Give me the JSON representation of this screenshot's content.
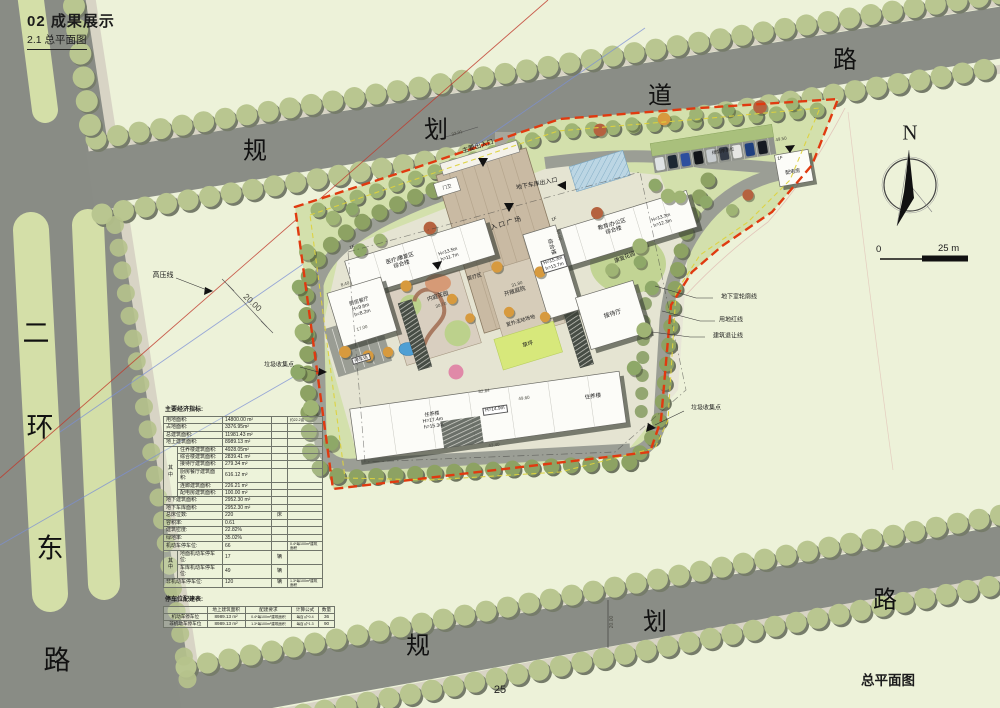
{
  "header": {
    "title": "02  成果展示",
    "subtitle": "2.1 总平面图"
  },
  "roads": {
    "top": [
      "规",
      "划",
      "道",
      "路"
    ],
    "left": [
      "二",
      "环",
      "东",
      "路"
    ],
    "bottom": [
      "规",
      "划",
      "路"
    ]
  },
  "compass": {
    "north": "N"
  },
  "scale": {
    "zero": "0",
    "max": "25 m"
  },
  "plan": {
    "labels": {
      "main_entrance": "主要出入口",
      "garage_entrance": "地下车库出入口",
      "entrance_plaza": "入 口 广 场",
      "bldg_medical": "医疗/康复区\n综合楼",
      "bldg_medical_h": "H=13.5m\nh=11.7m",
      "bldg_edu": "教育/办公区\n综合楼",
      "bldg_edu_h": "H=13.3m\nh=12.3m",
      "bldg_complex": "综合楼",
      "bldg_complex_h": "H=15.3m\nh=13.7m",
      "medical_zone": "医疗区",
      "kitchen": "厨房餐厅\nH=9.6m\nh=8.2m",
      "reception": "接待厅",
      "resident_main": "住养楼\nH=17.4m\nh=15.3m",
      "resident_h2": "H=14.9m",
      "resident_east": "住养楼",
      "power_room": "配电房",
      "floor_1f": "1F",
      "guard": "门卫",
      "shaded_parking": "绿荫停车位",
      "inner_garden": "内庭花园",
      "open_court": "开敞庭院",
      "outdoor_field": "室外活动场地",
      "lawn": "草坪",
      "rehab_garden": "康复花园",
      "parking_lot": "停车场",
      "hv_line": "高压线",
      "trash_point": "垃圾收集点",
      "underground_line": "地下室轮廓线",
      "land_red_line": "用地红线",
      "setback_line": "建筑退让线"
    },
    "dims": {
      "d3391": "33.91",
      "d2000L": "20.00",
      "d2000B": "20.00",
      "d4950": "49.50",
      "d8284": "82.84",
      "d4960": "49.60",
      "d4340": "43.40",
      "d840": "8.40",
      "d1700": "17.00",
      "d3070": "30.70",
      "d3180": "31.80",
      "d4400": "44.00"
    }
  },
  "tables": {
    "main": {
      "title": "主要经济指标:",
      "rows": [
        {
          "label": "用地面积:",
          "value": "14800.00 m²",
          "unit": "",
          "note": "约22.2亩"
        },
        {
          "label": "占地面积:",
          "value": "3376.95m²"
        },
        {
          "label": "总建筑面积:",
          "value": "11981.43 m²"
        },
        {
          "label": "地上建筑面积:",
          "value": "8989.13 m²"
        },
        {
          "group": "其中",
          "label": "住养楼建筑面积:",
          "value": "4928.05m²"
        },
        {
          "label": "综合楼建筑面积:",
          "value": "2839.41 m²"
        },
        {
          "label": "接待厅建筑面积:",
          "value": "279.34 m²"
        },
        {
          "label": "厨房餐厅建筑面积:",
          "value": "616.12 m²"
        },
        {
          "label": "连廊建筑面积:",
          "value": "226.21 m²"
        },
        {
          "label": "配电房建筑面积:",
          "value": "100.00 m²"
        },
        {
          "label": "地下建筑面积:",
          "value": "2952.30 m²"
        },
        {
          "label": "地下车库面积:",
          "value": "2952.30 m²"
        },
        {
          "label": "总床位数:",
          "value": "220",
          "unit": "床"
        },
        {
          "label": "容积率:",
          "value": "0.61"
        },
        {
          "label": "建筑密度:",
          "value": "22.82%"
        },
        {
          "label": "绿地率:",
          "value": "35.02%"
        },
        {
          "label": "机动车停车位:",
          "value": "66",
          "note": "0.4*每100m²建筑面积"
        },
        {
          "group": "其中",
          "label": "地面机动车停车位:",
          "value": "17",
          "unit": "辆"
        },
        {
          "label": "车库机动车停车位:",
          "value": "49",
          "unit": "辆"
        },
        {
          "label": "非机动车停车位:",
          "value": "120",
          "unit": "辆",
          "note": "1.3*每100m²建筑面积"
        }
      ]
    },
    "parking": {
      "title": "停车位配建表:",
      "headers": [
        "",
        "地上建筑面积",
        "配建要求",
        "计算公式",
        "数量"
      ],
      "rows": [
        [
          "机动车停车位",
          "8989.13 m²",
          "0.4*每100m²建筑面积",
          "每百㎡*0.4",
          "36"
        ],
        [
          "非机动车停车位",
          "8989.13 m²",
          "1.3*每100m²建筑面积",
          "每百㎡*1.3",
          "90"
        ]
      ]
    }
  },
  "footer": {
    "page": "25",
    "caption": "总平面图"
  }
}
